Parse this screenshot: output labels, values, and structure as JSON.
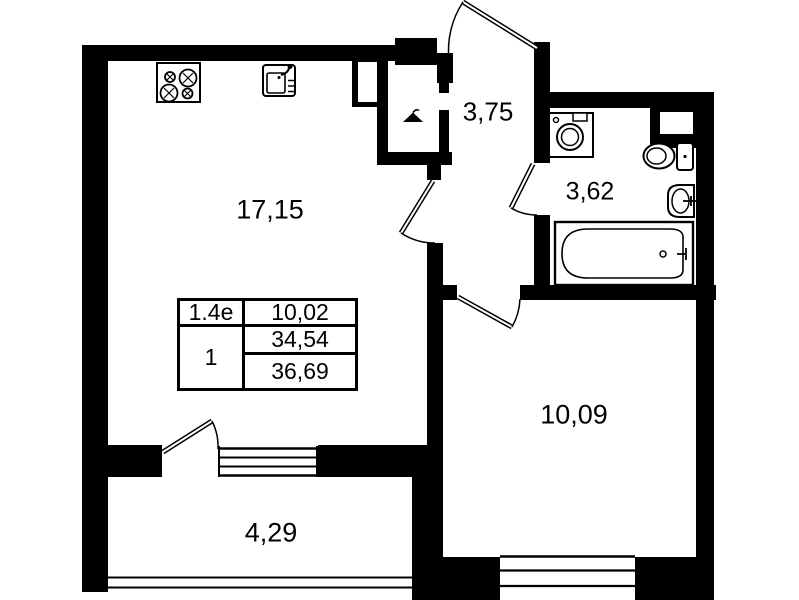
{
  "plan": {
    "colors": {
      "wall": "#000000",
      "background": "#ffffff",
      "text": "#000000"
    },
    "rooms": [
      {
        "name": "living-room-kitchen",
        "area": "17,15"
      },
      {
        "name": "hallway",
        "area": "3,75"
      },
      {
        "name": "bathroom",
        "area": "3,62"
      },
      {
        "name": "bedroom",
        "area": "10,09"
      },
      {
        "name": "balcony",
        "area": "4,29"
      }
    ],
    "info_table": {
      "unit_type": "1.4е",
      "living_area": "10,02",
      "rooms_count": "1",
      "area_without_balcony": "34,54",
      "total_area": "36,69"
    },
    "fixtures": [
      "stove",
      "kitchen-sink",
      "wardrobe-hanger",
      "washing-machine",
      "toilet",
      "washbasin",
      "bathtub"
    ]
  }
}
